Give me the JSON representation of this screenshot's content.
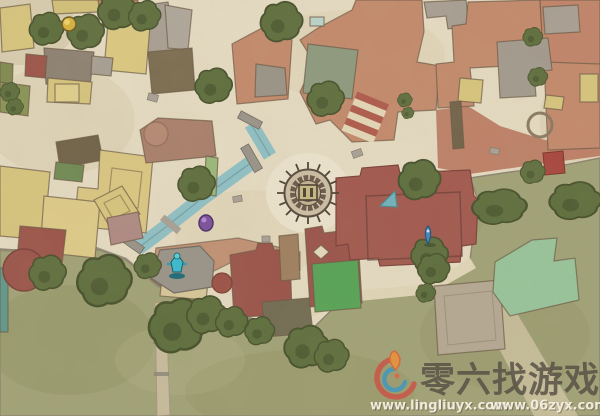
{
  "scene": {
    "title": "town-map",
    "description": "Hand-painted overhead game map of a town district with central sun plaza, canal, rooftops and lawns"
  },
  "watermark": {
    "site_name": "零六找游戏",
    "url_primary": "www.lingliuyx.com",
    "url_secondary": "www.06zyx.com"
  },
  "map": {
    "palette": {
      "parchment": "#e8dec5",
      "grass": "#a2a377",
      "terracotta_roof": "#c58a6d",
      "maroon_roof": "#9b5249",
      "khaki_roof": "#d9c77e",
      "gray_roof": "#a9a095",
      "water": "#8fc2c8",
      "tree": "#5d6e3c",
      "bright_green": "#55a455"
    },
    "markers": [
      {
        "id": "yellow-poi-marker",
        "color": "#d9b33c"
      },
      {
        "id": "purple-orb-marker",
        "color": "#7b4f9e"
      },
      {
        "id": "teal-statue-marker",
        "color": "#38bcd0"
      },
      {
        "id": "blue-waypoint-marker",
        "color": "#3f86c0"
      }
    ],
    "landmarks": [
      "central-sun-plaza",
      "canal",
      "statue-court",
      "terrace-pool",
      "fountain-circle",
      "stairs",
      "lawn"
    ]
  }
}
